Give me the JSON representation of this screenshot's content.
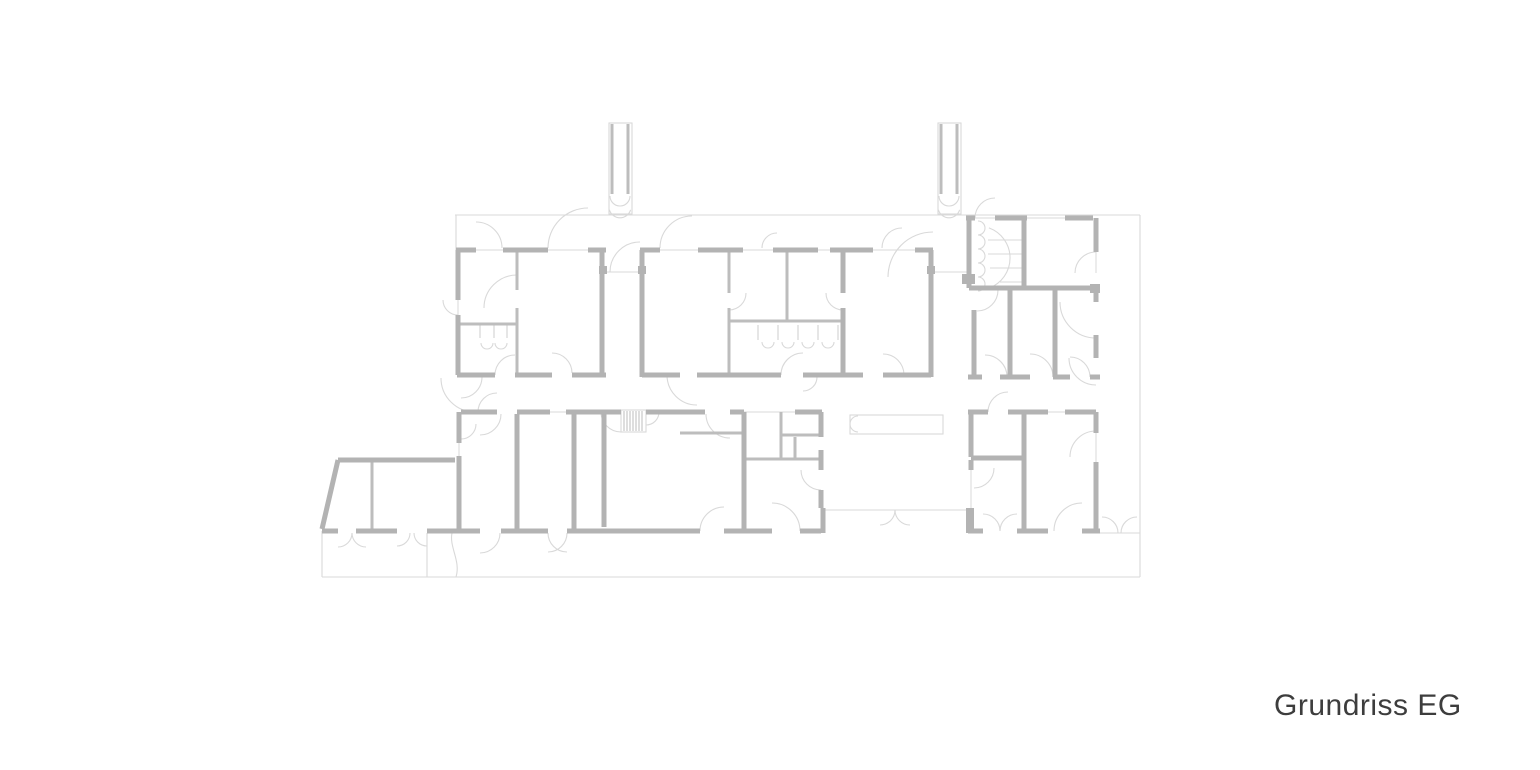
{
  "title": {
    "label": "Grundriss EG"
  },
  "plan": {
    "type": "architectural-floor-plan",
    "floor_label": "EG",
    "colors": {
      "background": "#ffffff",
      "wall": "#b3b3b3",
      "partition": "#bdbdbd",
      "outline": "#d9d9d9",
      "fixture": "#d4d4d4",
      "caption": "#3d3d3d"
    },
    "walls_thick": [
      [
        456,
        250,
        476,
        250
      ],
      [
        503,
        250,
        548,
        250
      ],
      [
        588,
        250,
        606,
        250
      ],
      [
        458,
        250,
        458,
        300
      ],
      [
        458,
        315,
        458,
        375
      ],
      [
        602,
        250,
        602,
        377
      ],
      [
        457,
        375,
        495,
        375
      ],
      [
        515,
        375,
        552,
        375
      ],
      [
        572,
        375,
        606,
        375
      ],
      [
        640,
        250,
        660,
        250
      ],
      [
        698,
        250,
        743,
        250
      ],
      [
        773,
        250,
        818,
        250
      ],
      [
        830,
        250,
        873,
        250
      ],
      [
        915,
        250,
        933,
        250
      ],
      [
        642,
        250,
        642,
        377
      ],
      [
        931,
        250,
        931,
        377
      ],
      [
        642,
        375,
        680,
        375
      ],
      [
        697,
        375,
        781,
        375
      ],
      [
        803,
        375,
        863,
        375
      ],
      [
        883,
        375,
        931,
        375
      ],
      [
        843,
        252,
        843,
        293
      ],
      [
        843,
        308,
        843,
        377
      ],
      [
        966,
        218,
        975,
        218
      ],
      [
        995,
        218,
        1027,
        218
      ],
      [
        1065,
        218,
        1093,
        218
      ],
      [
        1096,
        218,
        1096,
        252
      ],
      [
        969,
        218,
        969,
        288
      ],
      [
        969,
        288,
        1100,
        288
      ],
      [
        1096,
        285,
        1096,
        302
      ],
      [
        1024,
        218,
        1024,
        288
      ],
      [
        974,
        310,
        974,
        377
      ],
      [
        1010,
        290,
        1010,
        377
      ],
      [
        1055,
        290,
        1055,
        377
      ],
      [
        1096,
        335,
        1096,
        358
      ],
      [
        968,
        377,
        982,
        377
      ],
      [
        1000,
        377,
        1030,
        377
      ],
      [
        1053,
        377,
        1070,
        377
      ],
      [
        1090,
        377,
        1100,
        377
      ],
      [
        461,
        412,
        497,
        412
      ],
      [
        517,
        412,
        550,
        412
      ],
      [
        566,
        412,
        621,
        412
      ],
      [
        646,
        412,
        705,
        412
      ],
      [
        730,
        412,
        744,
        412
      ],
      [
        459,
        412,
        459,
        443
      ],
      [
        459,
        456,
        459,
        531
      ],
      [
        517,
        414,
        517,
        531
      ],
      [
        574,
        414,
        574,
        531
      ],
      [
        604,
        414,
        604,
        527
      ],
      [
        744,
        412,
        744,
        533
      ],
      [
        795,
        412,
        822,
        412
      ],
      [
        821,
        412,
        821,
        437
      ],
      [
        821,
        450,
        821,
        470
      ],
      [
        821,
        490,
        821,
        508
      ],
      [
        823,
        508,
        823,
        533
      ],
      [
        457,
        531,
        480,
        531
      ],
      [
        501,
        531,
        548,
        531
      ],
      [
        567,
        531,
        700,
        531
      ],
      [
        724,
        531,
        772,
        531
      ],
      [
        800,
        531,
        821,
        531
      ],
      [
        968,
        412,
        988,
        412
      ],
      [
        1008,
        412,
        1048,
        412
      ],
      [
        1065,
        412,
        1096,
        412
      ],
      [
        971,
        412,
        971,
        457
      ],
      [
        971,
        458,
        1024,
        458
      ],
      [
        1024,
        412,
        1024,
        531
      ],
      [
        971,
        460,
        971,
        470
      ],
      [
        1096,
        412,
        1096,
        433
      ],
      [
        1096,
        462,
        1096,
        531
      ],
      [
        968,
        531,
        983,
        531
      ],
      [
        1017,
        531,
        1048,
        531
      ],
      [
        1082,
        531,
        1100,
        531
      ],
      [
        971,
        521,
        971,
        531
      ],
      [
        338,
        460,
        455,
        460
      ],
      [
        338,
        460,
        322,
        529
      ],
      [
        322,
        531,
        338,
        531
      ],
      [
        356,
        531,
        397,
        531
      ],
      [
        427,
        531,
        457,
        531
      ]
    ],
    "walls_mid": [
      [
        517,
        252,
        517,
        290
      ],
      [
        517,
        308,
        517,
        375
      ],
      [
        459,
        324,
        517,
        324
      ],
      [
        729,
        252,
        729,
        293
      ],
      [
        729,
        308,
        729,
        375
      ],
      [
        787,
        252,
        787,
        321
      ],
      [
        729,
        321,
        843,
        321
      ],
      [
        372,
        462,
        372,
        529
      ],
      [
        781,
        412,
        781,
        459
      ],
      [
        781,
        435,
        821,
        435
      ],
      [
        795,
        437,
        795,
        459
      ],
      [
        744,
        459,
        823,
        459
      ],
      [
        680,
        433,
        742,
        433
      ],
      [
        612,
        124,
        612,
        194
      ],
      [
        628,
        124,
        628,
        194
      ],
      [
        941,
        124,
        941,
        194
      ],
      [
        957,
        124,
        957,
        194
      ]
    ],
    "outline": [
      [
        455,
        215,
        1140,
        215
      ],
      [
        1140,
        215,
        1140,
        577
      ],
      [
        322,
        577,
        1140,
        577
      ],
      [
        456,
        215,
        456,
        250
      ],
      [
        322,
        531,
        322,
        577
      ],
      [
        427,
        533,
        427,
        577
      ],
      [
        1100,
        533,
        1140,
        533
      ],
      [
        606,
        272,
        640,
        272
      ],
      [
        933,
        272,
        968,
        272
      ],
      [
        823,
        510,
        966,
        510
      ],
      [
        744,
        412,
        795,
        412
      ],
      [
        988,
        240,
        1024,
        240
      ],
      [
        988,
        254,
        1024,
        254
      ],
      [
        990,
        268,
        1024,
        268
      ],
      [
        1000,
        282,
        1024,
        282
      ]
    ],
    "glass": [
      [
        476,
        250,
        503,
        250
      ],
      [
        548,
        250,
        588,
        250
      ],
      [
        660,
        250,
        698,
        250
      ],
      [
        743,
        250,
        773,
        250
      ],
      [
        818,
        250,
        830,
        250
      ],
      [
        873,
        250,
        915,
        250
      ],
      [
        975,
        218,
        995,
        218
      ],
      [
        1027,
        218,
        1065,
        218
      ],
      [
        458,
        300,
        458,
        315
      ],
      [
        1096,
        252,
        1096,
        273
      ],
      [
        459,
        443,
        459,
        456
      ],
      [
        971,
        470,
        971,
        521
      ],
      [
        1096,
        433,
        1096,
        462
      ],
      [
        550,
        412,
        566,
        412
      ],
      [
        1048,
        412,
        1065,
        412
      ]
    ],
    "arcs": [
      [
        476,
        248,
        26,
        270,
        360
      ],
      [
        588,
        248,
        40,
        180,
        270
      ],
      [
        692,
        248,
        32,
        180,
        270
      ],
      [
        777,
        248,
        15,
        180,
        270
      ],
      [
        902,
        248,
        20,
        180,
        270
      ],
      [
        995,
        218,
        20,
        180,
        270
      ],
      [
        640,
        272,
        30,
        180,
        270
      ],
      [
        933,
        277,
        45,
        180,
        270
      ],
      [
        517,
        308,
        33,
        180,
        270
      ],
      [
        729,
        293,
        17,
        0,
        90
      ],
      [
        843,
        293,
        17,
        90,
        180
      ],
      [
        458,
        300,
        15,
        90,
        180
      ],
      [
        515,
        375,
        20,
        180,
        270
      ],
      [
        552,
        373,
        20,
        270,
        360
      ],
      [
        697,
        375,
        30,
        90,
        180
      ],
      [
        803,
        375,
        22,
        180,
        270
      ],
      [
        803,
        377,
        14,
        0,
        90
      ],
      [
        883,
        375,
        21,
        270,
        360
      ],
      [
        1096,
        273,
        21,
        180,
        270
      ],
      [
        1096,
        302,
        36,
        90,
        180
      ],
      [
        1096,
        358,
        27,
        90,
        180
      ],
      [
        978,
        258,
        32,
        -70,
        70
      ],
      [
        977,
        290,
        21,
        0,
        90
      ],
      [
        985,
        377,
        22,
        270,
        360
      ],
      [
        1030,
        377,
        23,
        270,
        360
      ],
      [
        1070,
        377,
        20,
        270,
        360
      ],
      [
        475,
        378,
        34,
        90,
        180
      ],
      [
        497,
        412,
        19,
        180,
        270
      ],
      [
        480,
        414,
        21,
        0,
        90
      ],
      [
        461,
        377,
        21,
        0,
        90
      ],
      [
        461,
        424,
        15,
        0,
        90
      ],
      [
        621,
        412,
        20,
        90,
        180
      ],
      [
        646,
        412,
        13,
        0,
        90
      ],
      [
        730,
        414,
        24,
        90,
        180
      ],
      [
        821,
        470,
        20,
        90,
        180
      ],
      [
        1008,
        412,
        20,
        180,
        270
      ],
      [
        974,
        468,
        20,
        0,
        90
      ],
      [
        1096,
        457,
        26,
        180,
        270
      ],
      [
        983,
        531,
        17,
        270,
        360
      ],
      [
        1017,
        531,
        17,
        180,
        270
      ],
      [
        1082,
        531,
        28,
        180,
        270
      ],
      [
        1102,
        533,
        16,
        270,
        360
      ],
      [
        1137,
        533,
        16,
        180,
        270
      ],
      [
        880,
        510,
        15,
        0,
        90
      ],
      [
        910,
        510,
        15,
        90,
        180
      ],
      [
        480,
        533,
        20,
        0,
        90
      ],
      [
        548,
        533,
        19,
        0,
        90
      ],
      [
        567,
        533,
        19,
        90,
        180
      ],
      [
        338,
        533,
        14,
        0,
        90
      ],
      [
        366,
        533,
        14,
        90,
        180
      ],
      [
        397,
        533,
        13,
        0,
        90
      ],
      [
        427,
        533,
        13,
        90,
        180
      ],
      [
        724,
        531,
        24,
        180,
        270
      ],
      [
        772,
        531,
        28,
        270,
        360
      ],
      [
        858,
        424,
        8,
        90,
        270
      ],
      [
        487,
        343,
        6,
        0,
        180
      ],
      [
        501,
        343,
        6,
        0,
        180
      ],
      [
        768,
        342,
        6,
        0,
        180
      ],
      [
        788,
        342,
        6,
        0,
        180
      ],
      [
        808,
        342,
        6,
        0,
        180
      ],
      [
        828,
        342,
        6,
        0,
        180
      ],
      [
        620,
        196,
        10,
        0,
        180
      ],
      [
        949,
        196,
        10,
        0,
        180
      ],
      [
        620,
        207,
        11,
        15,
        165
      ],
      [
        949,
        207,
        11,
        15,
        165
      ],
      [
        978,
        228,
        7,
        -90,
        90
      ],
      [
        978,
        242,
        7,
        -90,
        90
      ],
      [
        978,
        256,
        7,
        -90,
        90
      ],
      [
        978,
        270,
        7,
        -90,
        90
      ],
      [
        978,
        284,
        7,
        -90,
        90
      ]
    ],
    "fixtures": [
      [
        480,
        324,
        480,
        338
      ],
      [
        494,
        324,
        494,
        338
      ],
      [
        507,
        324,
        507,
        338
      ],
      [
        758,
        325,
        758,
        340
      ],
      [
        778,
        325,
        778,
        340
      ],
      [
        798,
        325,
        798,
        340
      ],
      [
        818,
        325,
        818,
        340
      ],
      [
        838,
        325,
        838,
        340
      ]
    ],
    "hatch": [
      [
        624,
        411,
        624,
        431
      ],
      [
        627,
        411,
        627,
        431
      ],
      [
        630,
        411,
        630,
        431
      ],
      [
        633,
        411,
        633,
        431
      ],
      [
        636,
        411,
        636,
        431
      ],
      [
        639,
        411,
        639,
        431
      ],
      [
        642,
        411,
        642,
        431
      ]
    ],
    "rects": [
      [
        609,
        123,
        23,
        91
      ],
      [
        938,
        123,
        23,
        91
      ],
      [
        850,
        415,
        93,
        19
      ],
      [
        621,
        410,
        25,
        22
      ]
    ],
    "piers": [
      [
        599,
        266,
        8,
        8
      ],
      [
        638,
        266,
        8,
        8
      ],
      [
        927,
        266,
        8,
        8
      ],
      [
        962,
        274,
        13,
        10
      ],
      [
        1090,
        284,
        10,
        9
      ],
      [
        966,
        508,
        8,
        25
      ]
    ],
    "curves": [
      "M452,533 C449,547 461,561 456,577"
    ]
  }
}
